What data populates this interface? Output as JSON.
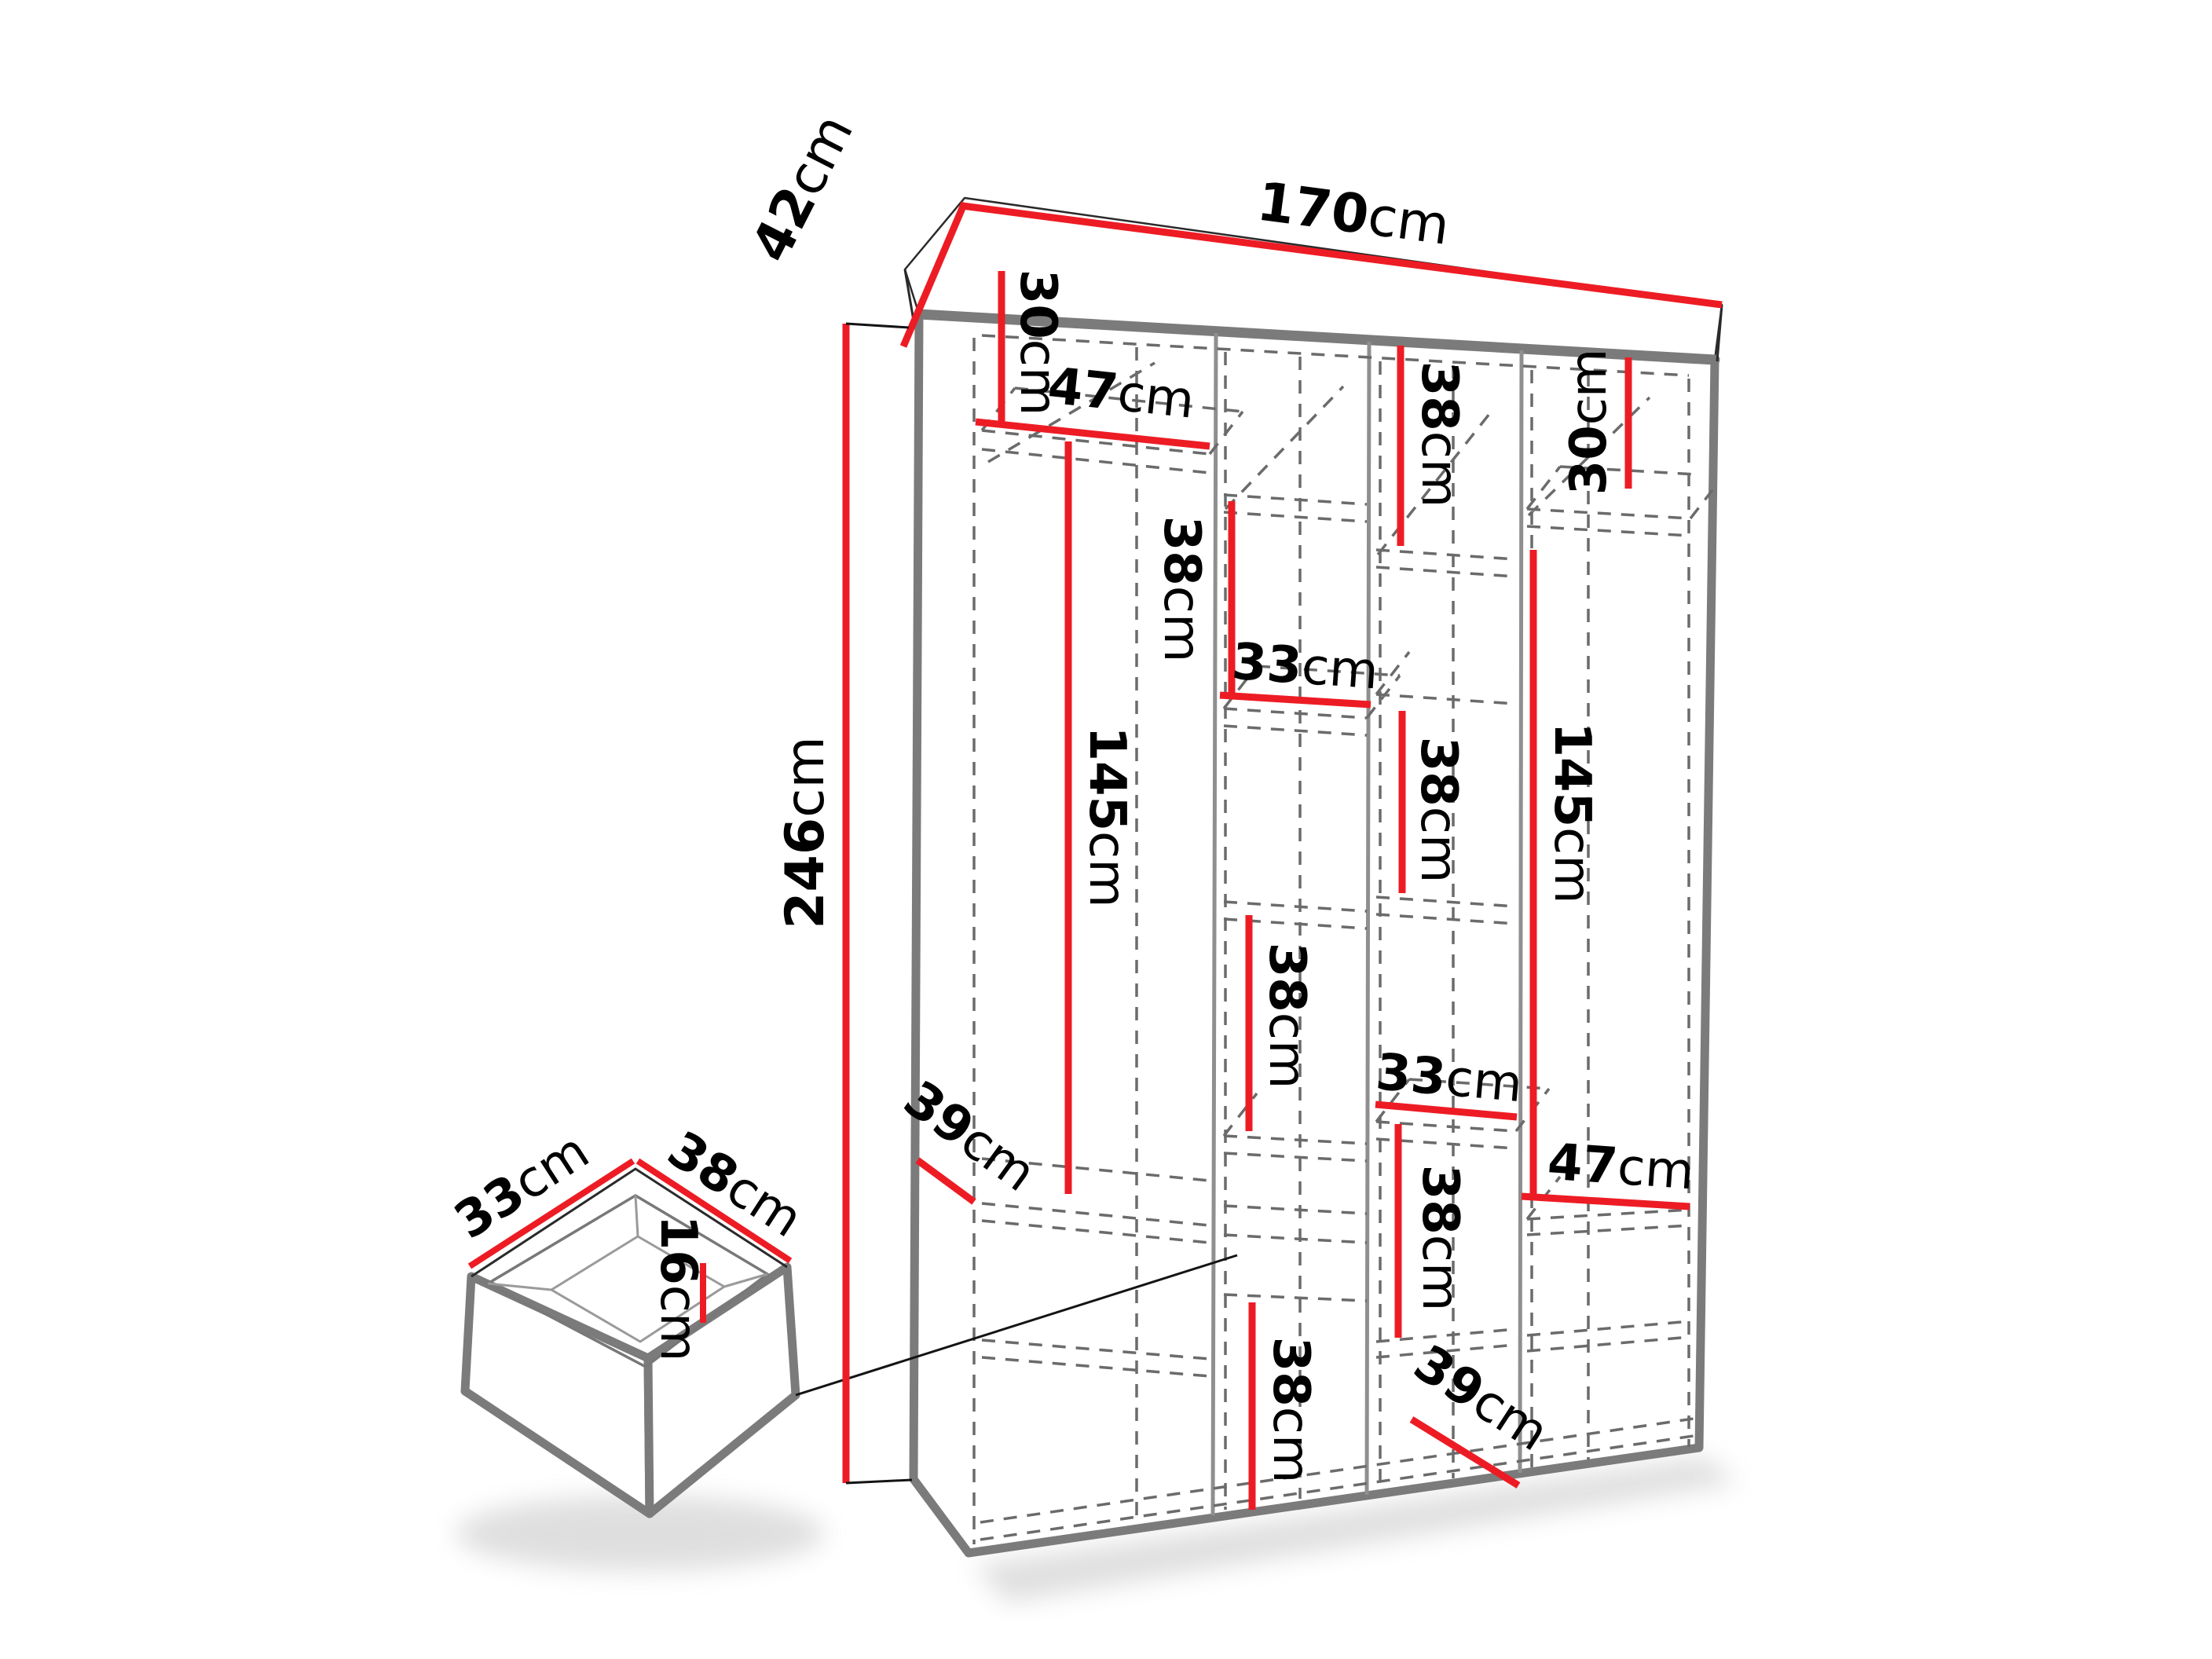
{
  "diagram": {
    "type": "furniture-dimension-diagram",
    "subject": "wardrobe with drawer detail",
    "unit": "cm"
  },
  "colors": {
    "dimension": "#ed1c24",
    "outline": "#7b7b7b",
    "edge": "#2a2a2a",
    "dashed": "#6b6b6b",
    "divider": "#8f8f8f",
    "text": "#000000",
    "background": "#ffffff"
  },
  "wardrobe": {
    "overall": {
      "width": {
        "v": "170",
        "u": "cm"
      },
      "depth": {
        "v": "42",
        "u": "cm"
      },
      "height": {
        "v": "246",
        "u": "cm"
      }
    },
    "sections": {
      "col1_top_height": {
        "v": "30",
        "u": "cm"
      },
      "col1_width": {
        "v": "47",
        "u": "cm"
      },
      "col1_hanging_height": {
        "v": "145",
        "u": "cm"
      },
      "col2_upper_height": {
        "v": "38",
        "u": "cm"
      },
      "col2_width": {
        "v": "33",
        "u": "cm"
      },
      "col2_middle_height": {
        "v": "38",
        "u": "cm"
      },
      "col2_lower_height": {
        "v": "38",
        "u": "cm"
      },
      "col3_top_height": {
        "v": "38",
        "u": "cm"
      },
      "col3_middle_height": {
        "v": "38",
        "u": "cm"
      },
      "col3_width": {
        "v": "33",
        "u": "cm"
      },
      "col3_lower_height": {
        "v": "38",
        "u": "cm"
      },
      "col4_top_height": {
        "v": "30",
        "u": "cm"
      },
      "col4_hanging_height": {
        "v": "145",
        "u": "cm"
      },
      "col4_width": {
        "v": "47",
        "u": "cm"
      },
      "left_shelf_depth": {
        "v": "39",
        "u": "cm"
      },
      "bottom_shelf_depth": {
        "v": "39",
        "u": "cm"
      }
    }
  },
  "drawer": {
    "depth": {
      "v": "33",
      "u": "cm"
    },
    "width": {
      "v": "38",
      "u": "cm"
    },
    "height": {
      "v": "16",
      "u": "cm"
    }
  }
}
